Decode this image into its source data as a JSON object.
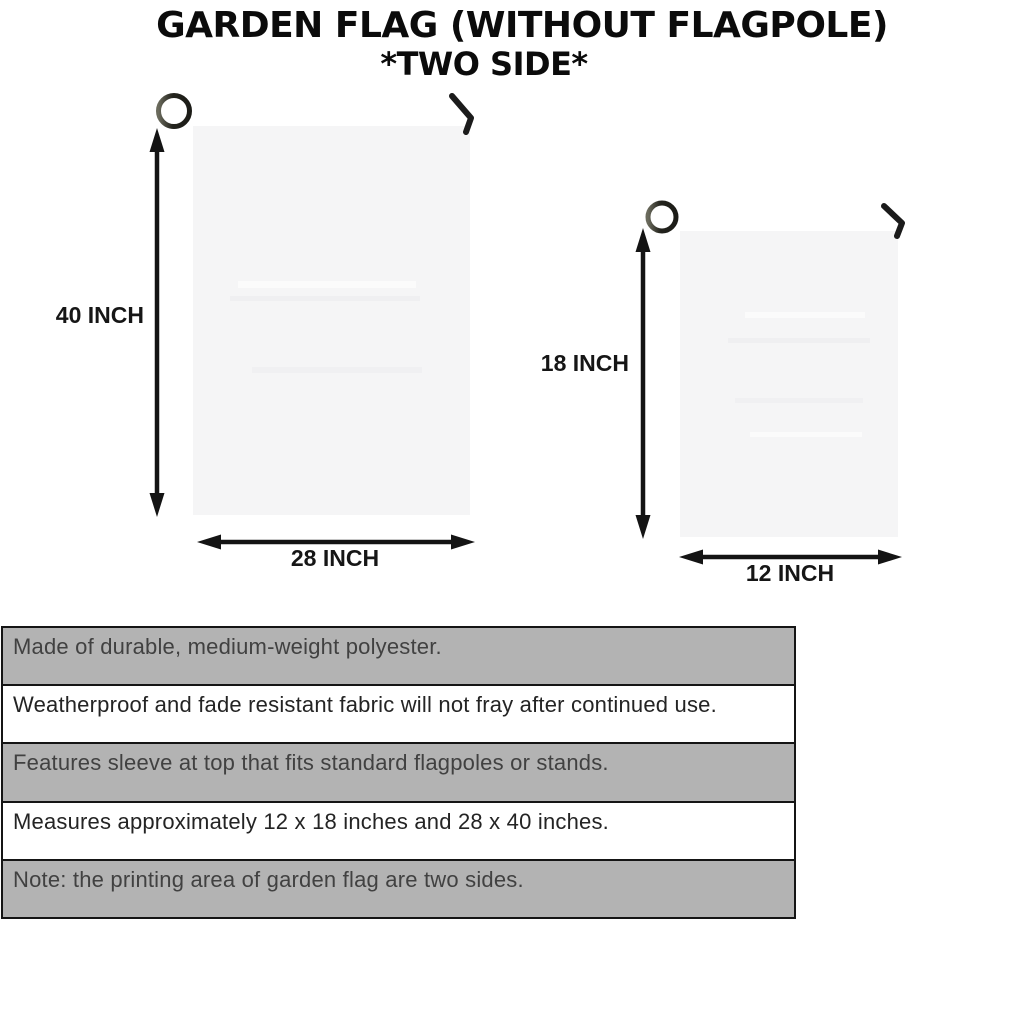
{
  "title": {
    "line1": "GARDEN FLAG (WITHOUT FLAGPOLE)",
    "line2": "*TWO SIDE*"
  },
  "figures": {
    "large_flag": {
      "height_label": "40 INCH",
      "width_label": "28 INCH"
    },
    "small_flag": {
      "height_label": "18 INCH",
      "width_label": "12 INCH"
    }
  },
  "spec_rows": [
    "Made of durable, medium-weight polyester.",
    "Weatherproof and fade resistant fabric will not fray after continued use.",
    "Features sleeve at top that fits standard flagpoles or stands.",
    "Measures approximately 12 x 18 inches and 28 x 40 inches.",
    "Note: the printing area of garden flag are two sides."
  ],
  "colors": {
    "shaded_row": "#b3b3b3",
    "plain_row": "#ffffff",
    "flag_fill": "#f5f5f6",
    "pole_dark": "#23231d",
    "pole_light": "#57574a",
    "arrow": "#141414",
    "table_border": "#151515",
    "title_text": "#0b0b0b"
  }
}
